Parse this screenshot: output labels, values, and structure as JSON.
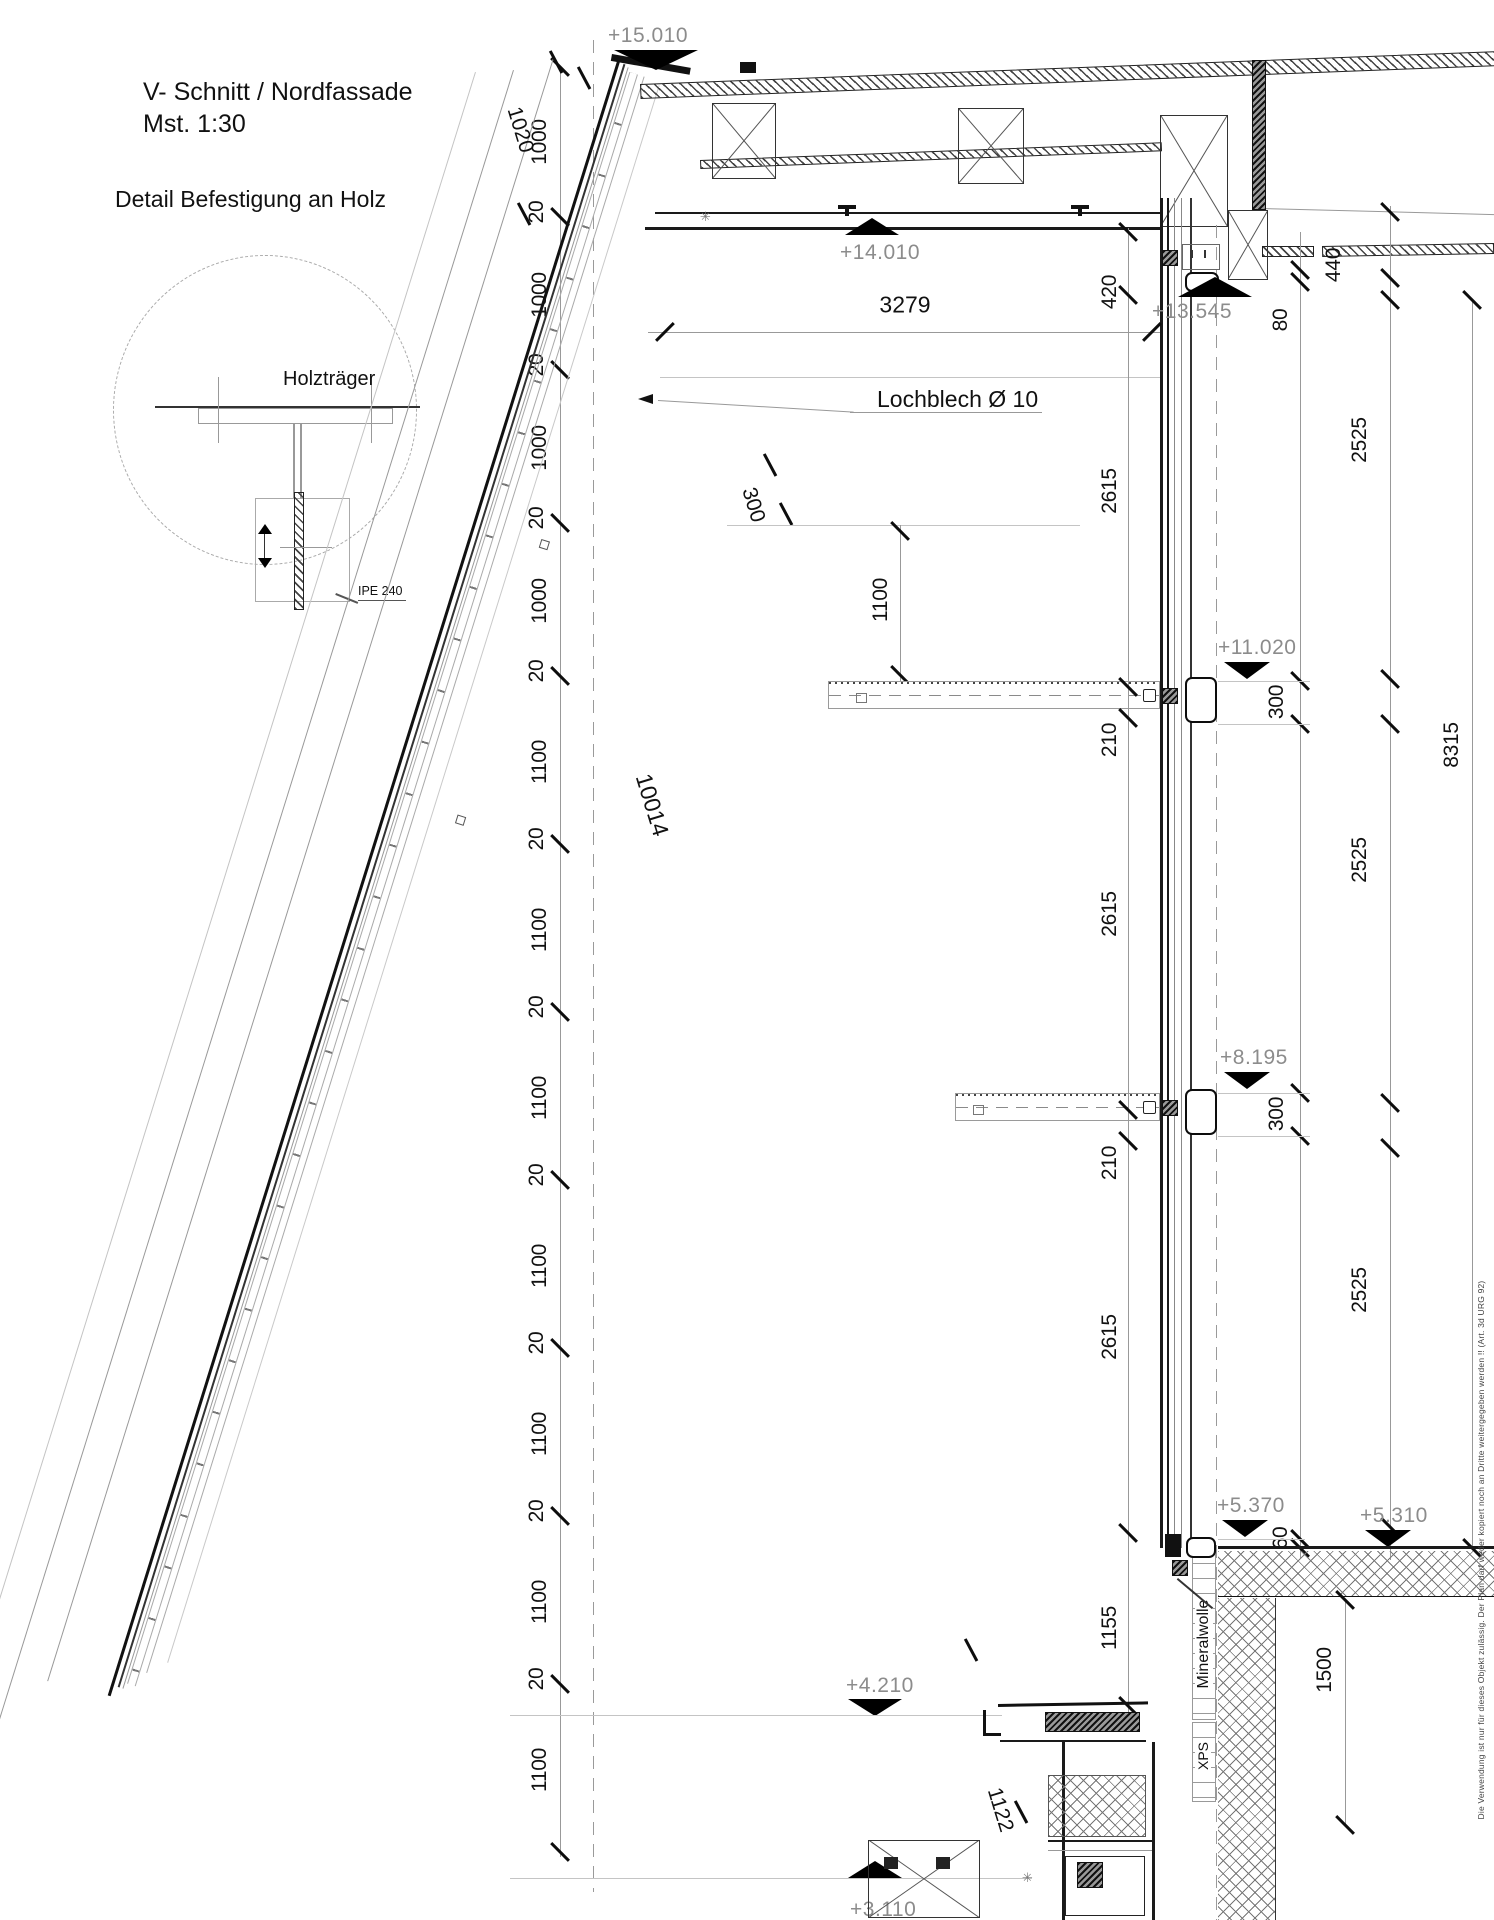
{
  "titles": {
    "section": "V- Schnitt / Nordfassade",
    "scale": "Mst. 1:30",
    "detail": "Detail Befestigung an Holz"
  },
  "detail": {
    "beam_label": "Holzträger",
    "profile_label": "IPE 240"
  },
  "left_chain": {
    "items": [
      "1000",
      "20",
      "1000",
      "20",
      "1000",
      "20",
      "1000",
      "20",
      "1100",
      "20",
      "1100",
      "20",
      "1100",
      "20",
      "1100",
      "20",
      "1100",
      "20",
      "1100",
      "20",
      "1100"
    ]
  },
  "elevations": {
    "top": "+15.010",
    "ceiling": "+14.010",
    "wallhead": "+13.545",
    "strut1": "+11.020",
    "strut2": "+8.195",
    "floor": "+5.370",
    "floor2": "+5.310",
    "sill": "+4.210",
    "base": "+3.110"
  },
  "dims": {
    "slope_top": "1020",
    "slope_total": "10014",
    "slope_bottom": "1122",
    "slope_seg": "300",
    "vert_offset": "1100",
    "ceiling_width": "3279",
    "col_inner": [
      "420",
      "2615",
      "210",
      "2615",
      "210",
      "2615",
      "1155"
    ],
    "col_small": [
      "80",
      "300",
      "300",
      "60"
    ],
    "col_floor": [
      "440",
      "2525",
      "2525",
      "2525"
    ],
    "total_height": "8315",
    "wall_below": "1500"
  },
  "labels": {
    "perforated": "Lochblech Ø 10",
    "insulation": "Mineralwolle",
    "xps": "XPS"
  },
  "footer": {
    "copyright": "Die Verwendung ist nur für dieses Objekt zulässig. Der Plan darf weder kopiert noch an Dritte weitergegeben werden !!   (Art. 3d URG 92)"
  }
}
